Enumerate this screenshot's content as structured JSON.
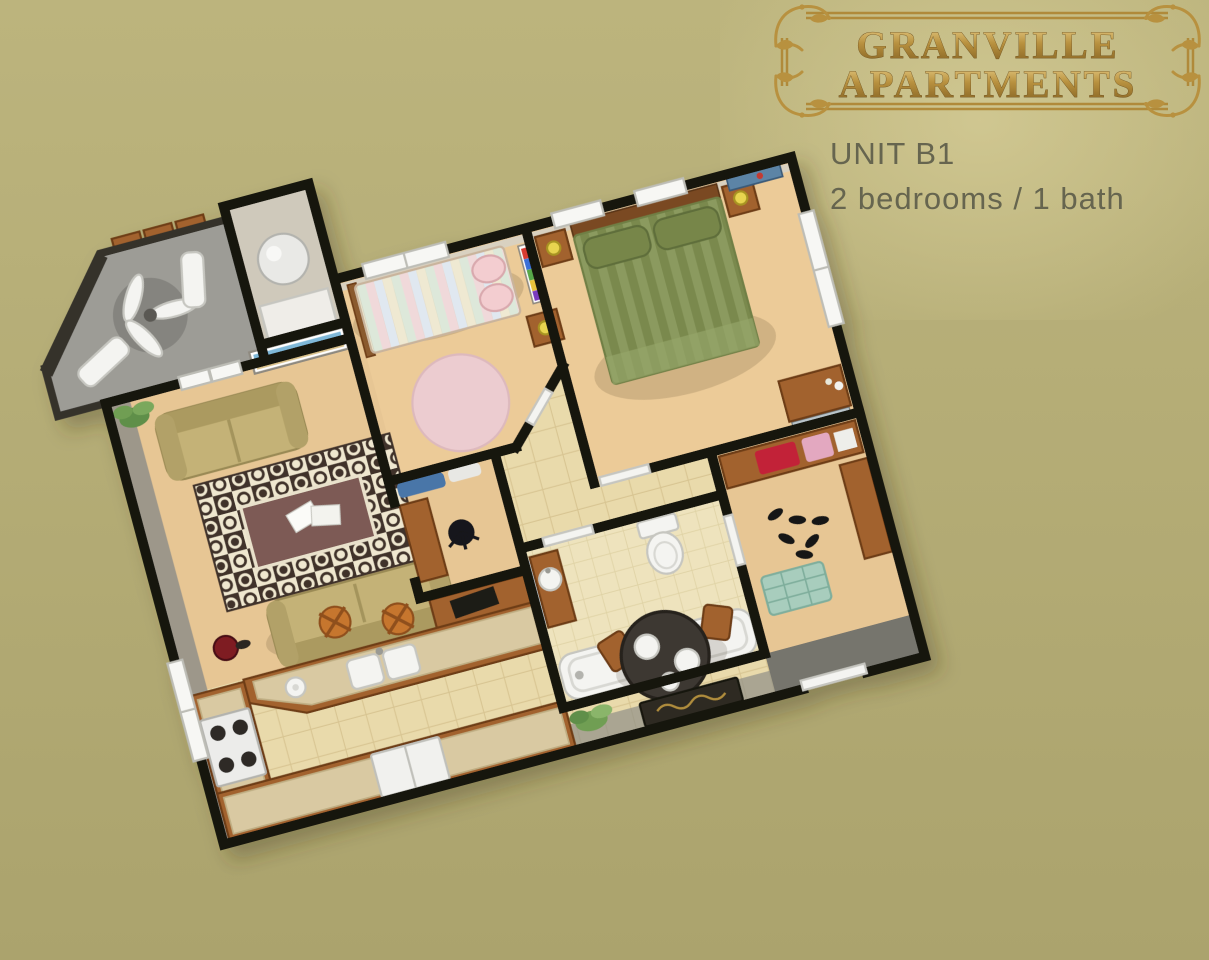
{
  "header": {
    "brand_line1": "GRANVILLE",
    "brand_line2": "APARTMENTS",
    "unit": "UNIT B1",
    "specs": "2 bedrooms / 1 bath"
  },
  "floorplan": {
    "rooms": [
      "balcony",
      "utility-closet",
      "bedroom-2",
      "master-bedroom",
      "living-room",
      "office-nook",
      "hallway",
      "bathroom",
      "walk-in-closet",
      "kitchen",
      "dining-area",
      "entry"
    ],
    "furniture": [
      "ceiling-fan",
      "lounge-chairs",
      "water-heater",
      "loveseat",
      "sofa",
      "area-rug",
      "beach-painting",
      "twin-bed",
      "round-pink-rug",
      "queen-bed",
      "nightstand-lamp",
      "dresser-with-mirror",
      "toilet",
      "bathtub",
      "pedestal-sink",
      "stove",
      "refrigerator",
      "double-sink",
      "bar-stools",
      "dining-table",
      "doormat",
      "house-plant",
      "closet-shelves"
    ]
  },
  "palette": {
    "bg": "#b3ab74",
    "bgGlow": "#d2c993",
    "goldLight": "#ecd28c",
    "gold": "#b8913f",
    "goldDark": "#7e5c1f",
    "inkGray": "#66654f",
    "wall": "#17140f",
    "wallFace": "#d9d1c0",
    "carpet": "#e7c694",
    "carpetBed": "#eccb98",
    "tile": "#e9daab",
    "grout": "#d8c592",
    "bathTile": "#eee3bd",
    "bathGrout": "#dfd2a4",
    "balconyFloor": "#9d9c96",
    "balconyWall": "#35322c",
    "wood": "#a2622d",
    "woodDark": "#6e3d16",
    "sofa": "#c4b277",
    "sofaDark": "#ab9a60",
    "rugField": "#efe7cf",
    "rugDark": "#41332a",
    "rugCenter": "#7d5a54",
    "rugPink": "#ecccd0",
    "greenA": "#8b9a5e",
    "greenB": "#7a894e",
    "pillowGreen": "#77864a",
    "white": "#f4f4f1",
    "whiteStroke": "#c6c6c0",
    "steel": "#2e2c28",
    "accentRed": "#c22338",
    "accentPink": "#e3a8c0",
    "teal": "#a8cdbd",
    "lampYellow": "#e8d44f",
    "blueArt": "#5b84a6",
    "denim": "#4a76a8",
    "entryFloor": "#76756d",
    "shadowBand": "#8f8e88"
  }
}
